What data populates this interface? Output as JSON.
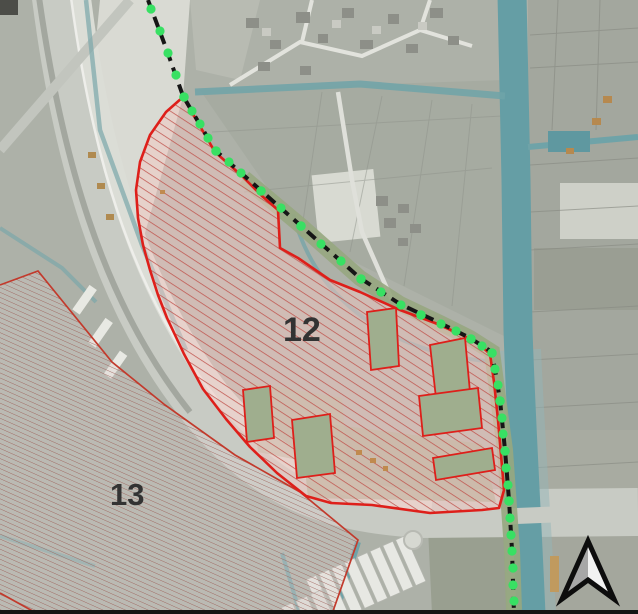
{
  "map": {
    "zones": [
      {
        "id": "12",
        "label": "12",
        "style": "red-diagonal-hatch",
        "border_color": "#de1f1a",
        "hatch_color": "#bf4f49"
      },
      {
        "id": "13",
        "label": "13",
        "style": "fine-red-hatch",
        "border_color": "#c23a2c",
        "hatch_color": "#9c5f58"
      }
    ],
    "boundary": {
      "name": "municipal-boundary-dashed-line",
      "line_color": "#161616",
      "marker_color": "#38e063"
    },
    "water_color": "#659ea5",
    "north_arrow_icon": "north-arrow"
  }
}
